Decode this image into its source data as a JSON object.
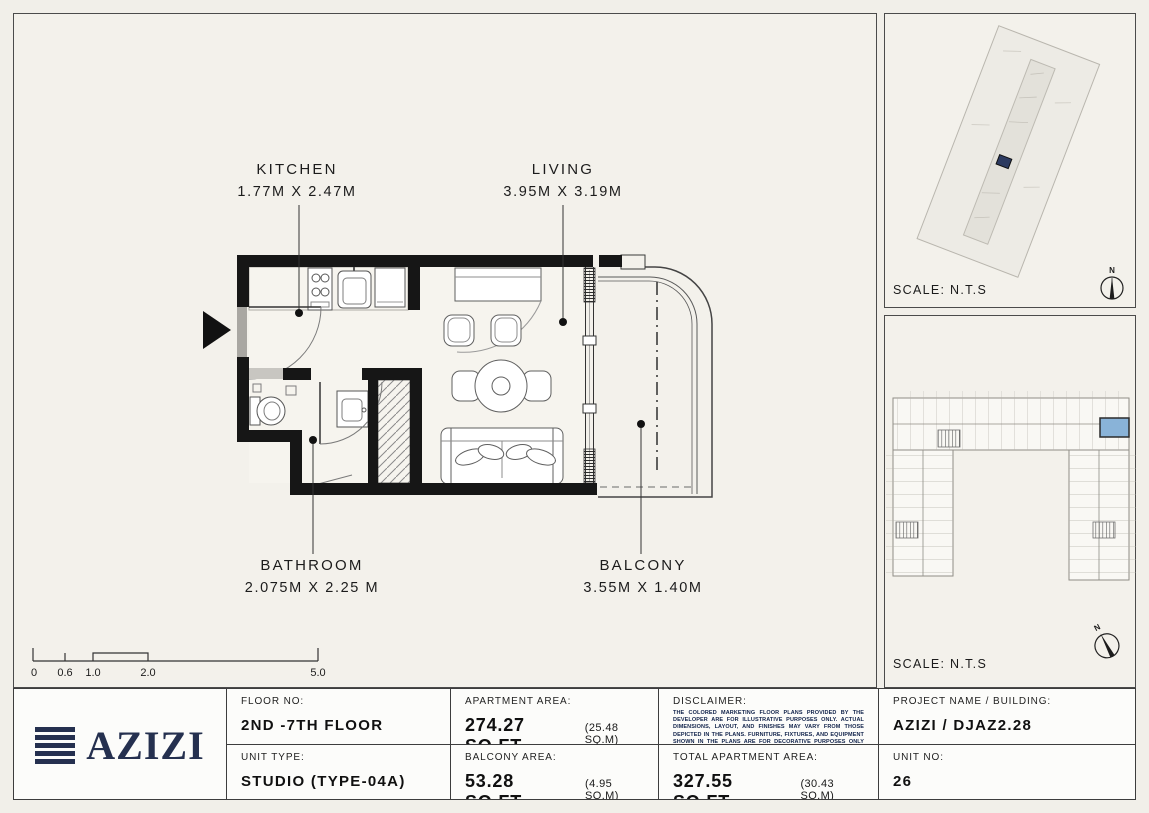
{
  "colors": {
    "accent_navy": "#25304f",
    "highlight_blue": "#89b3d8",
    "wall_black": "#161616",
    "paper_cream": "#f3f1eb"
  },
  "floor_plan": {
    "rooms": [
      {
        "id": "kitchen",
        "label": "KITCHEN",
        "dims": "1.77M X 2.47M"
      },
      {
        "id": "living",
        "label": "LIVING",
        "dims": "3.95M X 3.19M"
      },
      {
        "id": "bathroom",
        "label": "BATHROOM",
        "dims": "2.075M X 2.25 M"
      },
      {
        "id": "balcony",
        "label": "BALCONY",
        "dims": "3.55M X 1.40M"
      }
    ],
    "scale_bar": {
      "ticks": [
        "0",
        "0.6",
        "1.0",
        "2.0",
        "5.0"
      ]
    }
  },
  "site_plan": {
    "scale_label": "SCALE: N.T.S",
    "compass_n": "N"
  },
  "key_plan": {
    "scale_label": "SCALE: N.T.S",
    "compass_n": "N"
  },
  "title_block": {
    "logo_text": "AZIZI",
    "floor": {
      "label": "FLOOR NO:",
      "value": "2ND -7TH FLOOR"
    },
    "unit_type": {
      "label": "UNIT TYPE:",
      "value": "STUDIO (TYPE-04A)"
    },
    "apartment_area": {
      "label": "APARTMENT AREA:",
      "value": "274.27 SQ.FT.",
      "metric": "(25.48 SQ.M)"
    },
    "balcony_area": {
      "label": "BALCONY AREA:",
      "value": "53.28 SQ.FT.",
      "metric": "(4.95 SQ.M)"
    },
    "disclaimer": {
      "label": "DISCLAIMER:",
      "text": "THE COLORED MARKETING FLOOR PLANS PROVIDED BY THE DEVELOPER ARE FOR ILLUSTRATIVE PURPOSES ONLY. ACTUAL DIMENSIONS, LAYOUT, AND FINISHES MAY VARY FROM THOSE DEPICTED IN THE PLANS. FURNITURE, FIXTURES, AND EQUIPMENT SHOWN IN THE PLANS ARE FOR DECORATIVE PURPOSES ONLY AND ARE NOT INCLUDED IN THE PURCHASE OR LEASE OF THE PROPERTY. THE DEVELOPER RESERVES THE RIGHT TO MAKE MODIFICATIONS, REVISIONS, AND CHANGES TO THE FLOOR PLANS, SPECIFICATIONS, AND FEATURES WITHOUT PRIOR NOTICE."
    },
    "total_area": {
      "label": "TOTAL APARTMENT AREA:",
      "value": "327.55 SQ.FT.",
      "metric": "(30.43 SQ.M)"
    },
    "project": {
      "label": "PROJECT NAME / BUILDING:",
      "value": "AZIZI / DJAZ2.28"
    },
    "unit_no": {
      "label": "UNIT NO:",
      "value": "26"
    }
  }
}
